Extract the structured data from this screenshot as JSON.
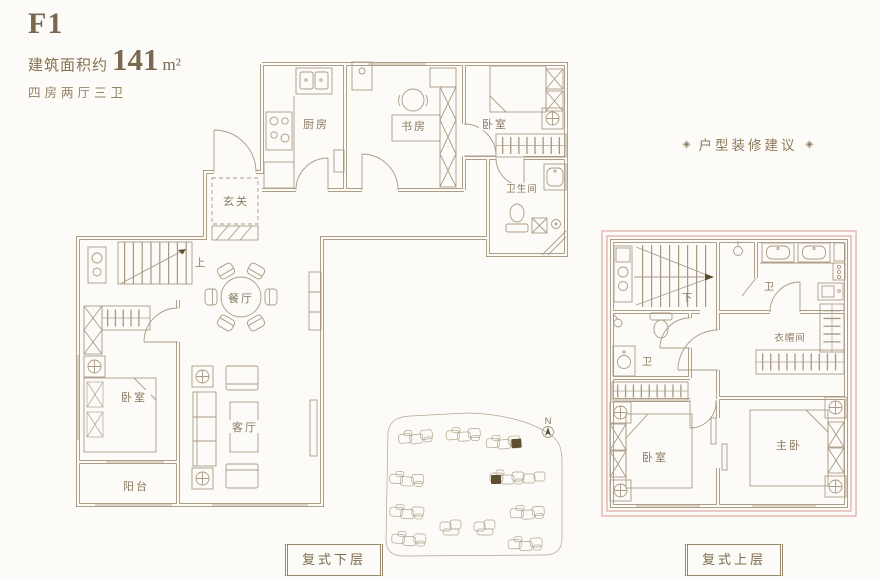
{
  "header": {
    "plan_code": "F1",
    "area_label": "建筑面积约",
    "area_value": "141",
    "area_unit": "m²",
    "layout_spec": "四房两厅三卫"
  },
  "decor": {
    "ornament": "◈",
    "suggestion_title": "户型装修建议"
  },
  "lower_floor": {
    "caption": "复式下层",
    "kitchen": "厨房",
    "study": "书房",
    "bedroom_top": "卧室",
    "bathroom": "卫生间",
    "foyer": "玄关",
    "stairs_up": "上",
    "dining": "餐厅",
    "bedroom": "卧室",
    "living": "客厅",
    "balcony": "阳台"
  },
  "upper_floor": {
    "caption": "复式上层",
    "stairs_down": "下",
    "bath_top": "卫",
    "bath_left": "卫",
    "cloakroom": "衣帽间",
    "bedroom": "卧室",
    "master_bedroom": "主卧"
  },
  "site_map": {
    "north": "N"
  },
  "colors": {
    "background": "#fcfbf7",
    "wall_line": "#a39076",
    "text_brown": "#8a7960",
    "accent_pink": "#e3a8a6",
    "highlight_dark": "#5e4f33"
  }
}
